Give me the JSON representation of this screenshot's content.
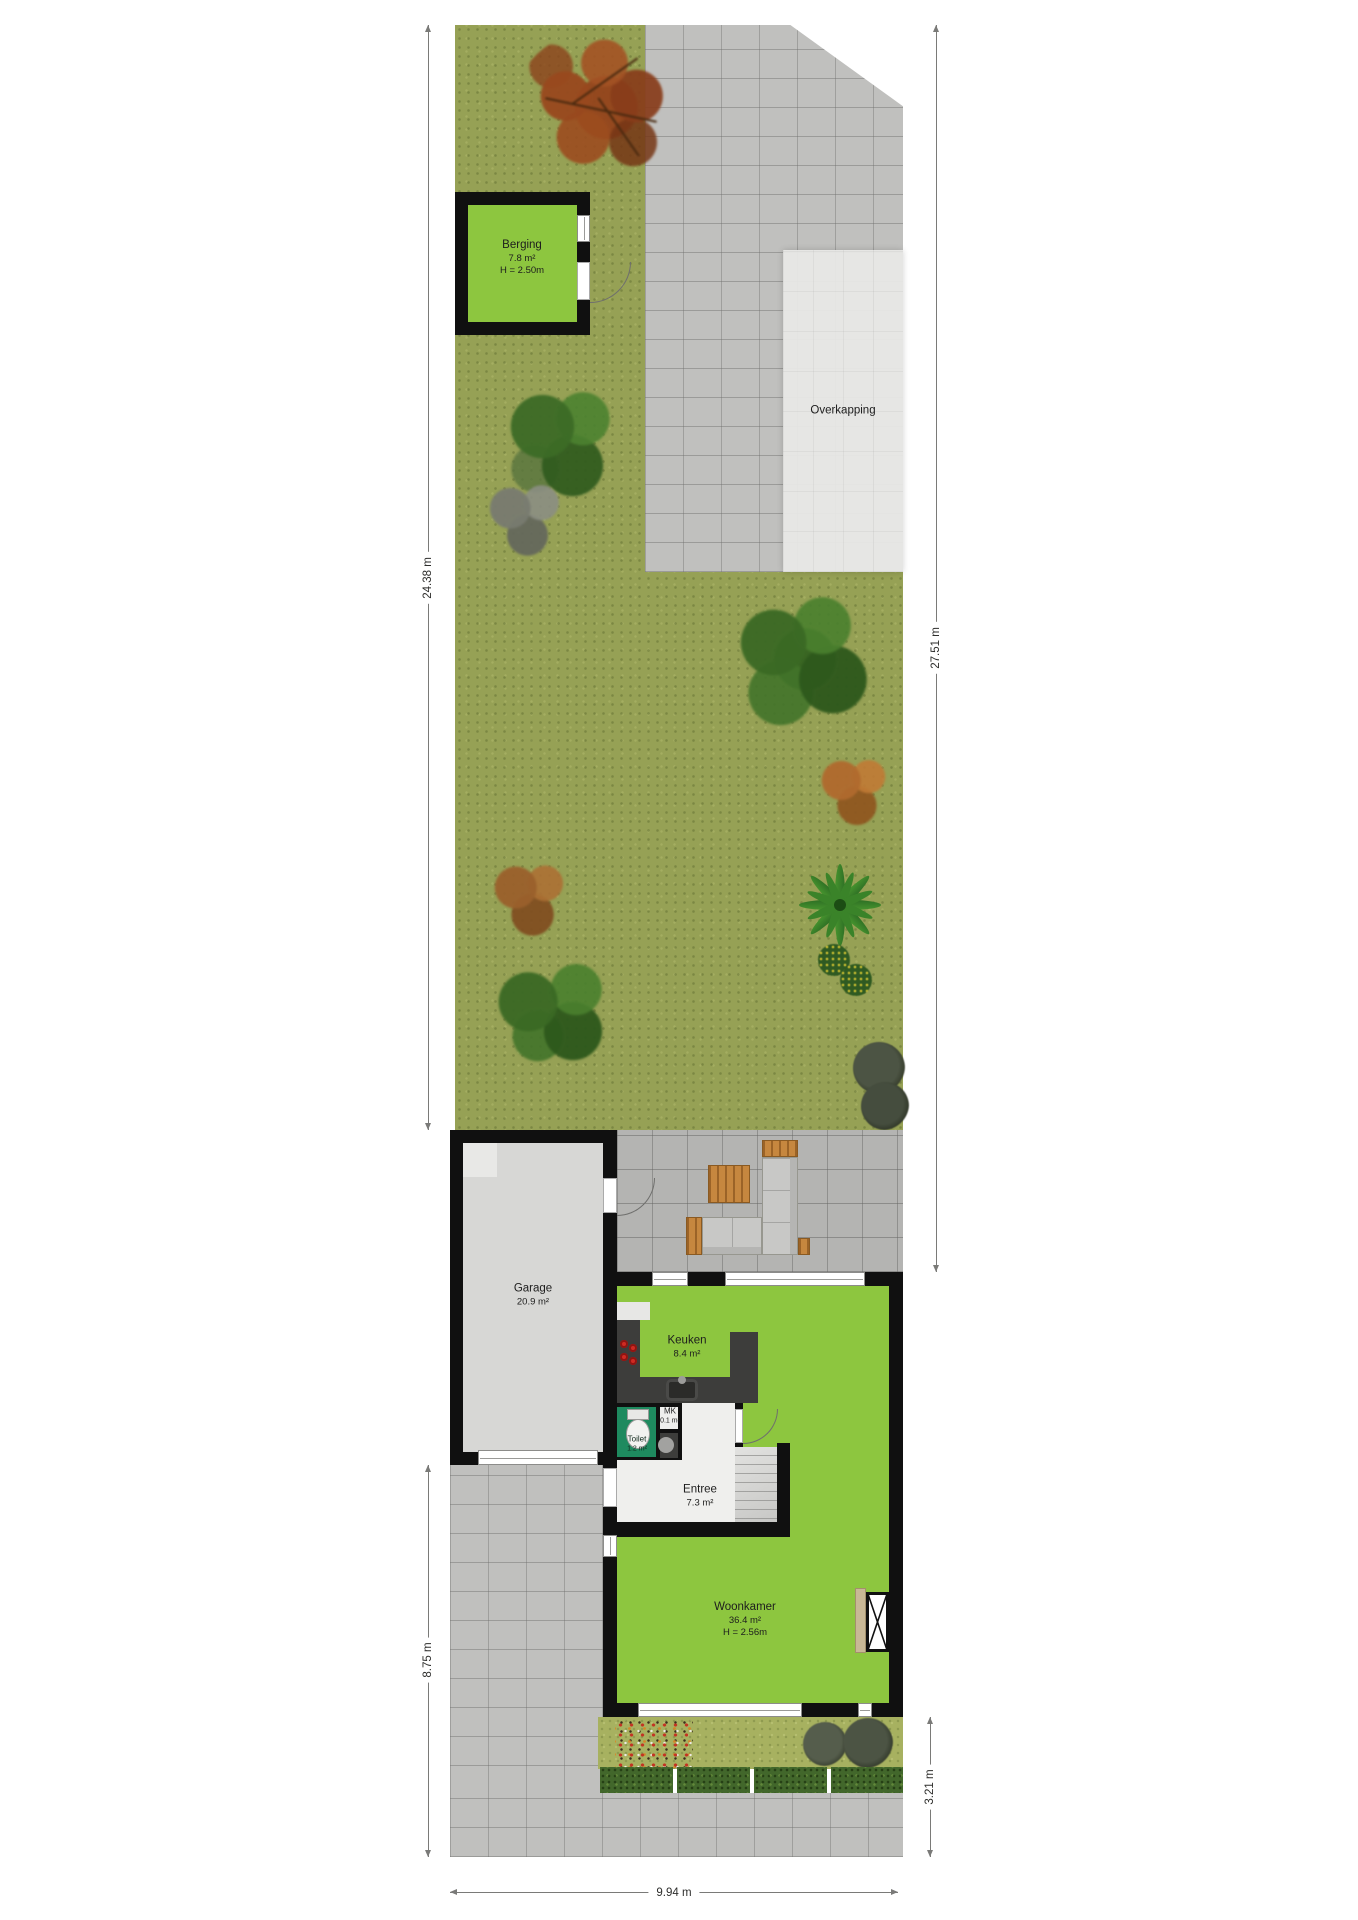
{
  "plan": {
    "title": "Situatie begane grond met tuin",
    "rooms": {
      "berging": {
        "name": "Berging",
        "area": "7.8 m²",
        "height": "H = 2.50m"
      },
      "overkapping": {
        "name": "Overkapping"
      },
      "garage": {
        "name": "Garage",
        "area": "20.9 m²"
      },
      "keuken": {
        "name": "Keuken",
        "area": "8.4 m²"
      },
      "toilet": {
        "name": "Toilet",
        "area": "1.2 m²"
      },
      "mk": {
        "name": "MK",
        "area": "0.1 m²"
      },
      "entree": {
        "name": "Entree",
        "area": "7.3 m²"
      },
      "woonkamer": {
        "name": "Woonkamer",
        "area": "36.4 m²",
        "height": "H = 2.56m"
      }
    },
    "dimensions": {
      "rear_left": "24.38 m",
      "rear_right": "27.51 m",
      "front_left": "8.75 m",
      "front_right": "3.21 m",
      "bottom": "9.94 m"
    },
    "colors": {
      "grass": "#96a155",
      "front_grass": "#a7b160",
      "room_green": "#8dc63f",
      "toilet_green": "#1e8a5f",
      "paving": "#c0c0be",
      "terrace_paving": "#b4b4b2",
      "overkapping_roof": "#e7e7e5",
      "wall": "#101010",
      "wood": "#c6873f",
      "hedge": "#42672b"
    }
  }
}
